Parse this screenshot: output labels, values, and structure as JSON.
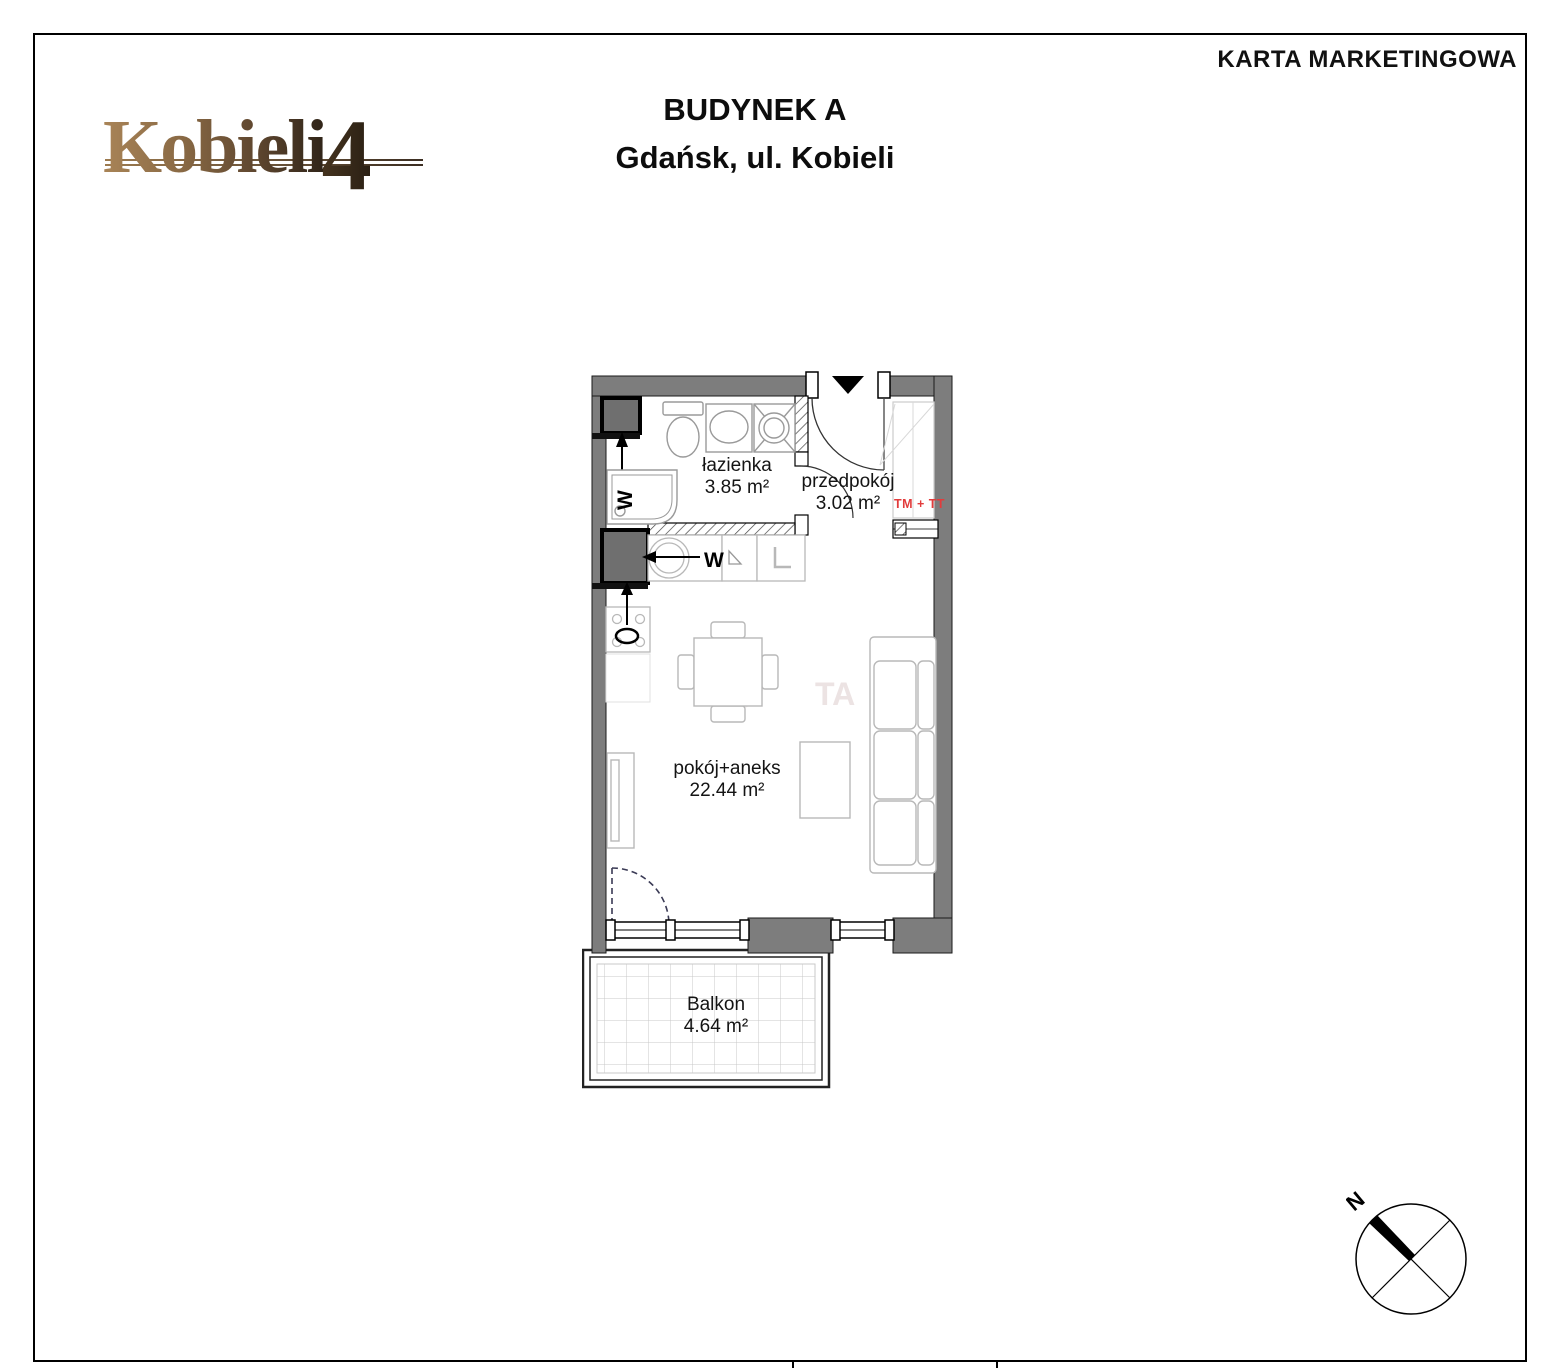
{
  "document": {
    "type_label": "KARTA MARKETINGOWA",
    "building_title": "BUDYNEK A",
    "address": "Gdańsk, ul. Kobieli",
    "logo_text": "Kobieli",
    "logo_number": "4"
  },
  "floorplan": {
    "rooms": [
      {
        "name": "łazienka",
        "area": "3.85 m²"
      },
      {
        "name": "przedpokój",
        "area": "3.02 m²"
      },
      {
        "name": "pokój+aneks",
        "area": "22.44 m²"
      },
      {
        "name": "Balkon",
        "area": "4.64 m²"
      }
    ],
    "labels": {
      "bath_vent": "W",
      "kitchen_vent": "W",
      "tm_tt": "TM + TT"
    },
    "watermark": "TA",
    "compass_north": "N",
    "colors": {
      "wall": "#7d7d7d",
      "shaft": "#6f6f6f",
      "annotation_red": "#e23c3c"
    }
  }
}
